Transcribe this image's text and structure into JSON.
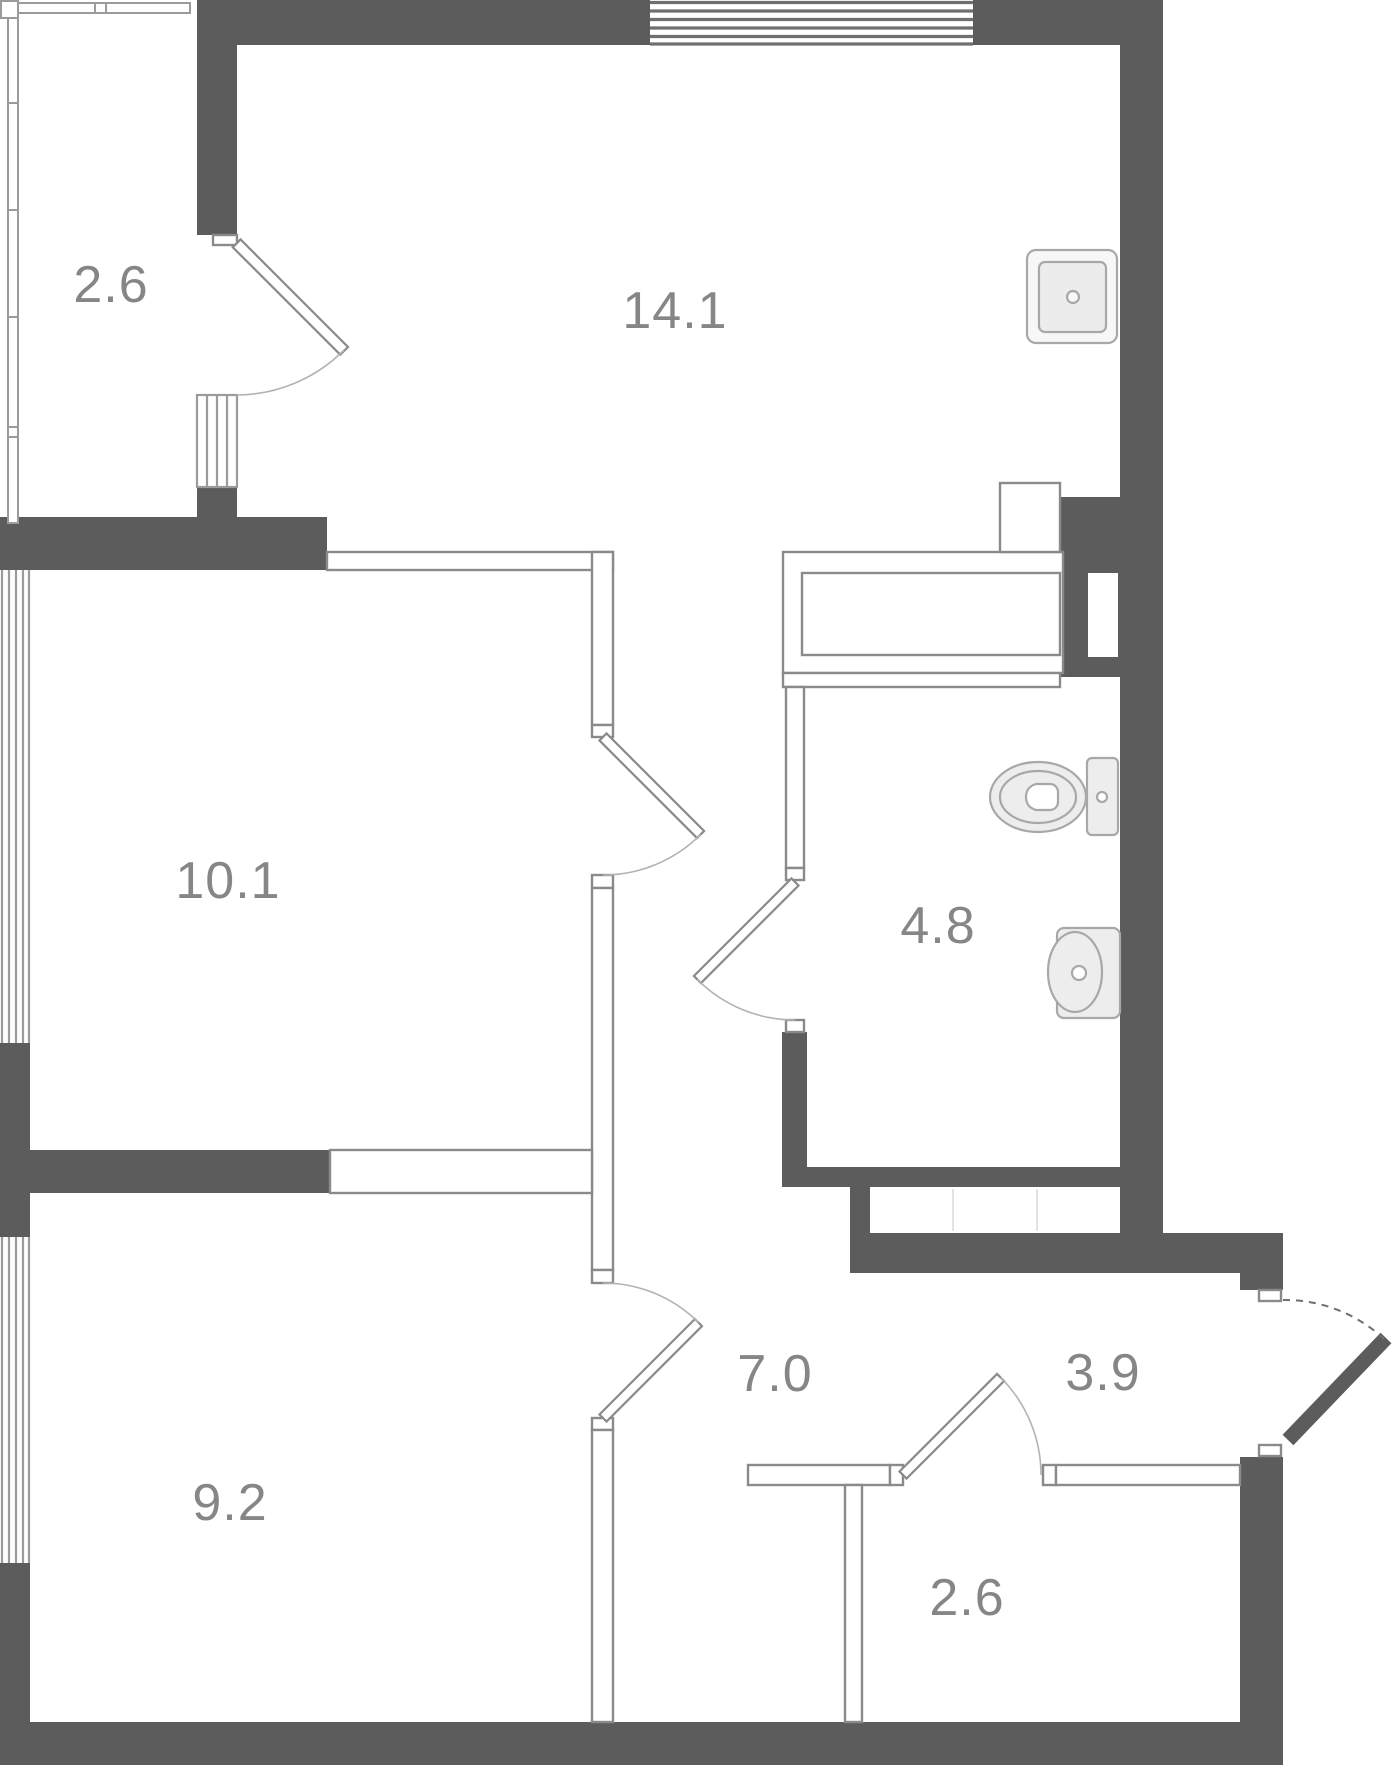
{
  "plan": {
    "type": "apartment-floor-plan",
    "colors": {
      "wall": "#5c5c5c",
      "thin_wall_line": "#8a8a8a",
      "window_line": "#9b9b9b",
      "door_arc": "#b3b3b3",
      "label": "#868686",
      "fixture_fill": "#f1f1f1",
      "fixture_stroke": "#a8a8a8",
      "background": "#ffffff"
    },
    "rooms": [
      {
        "id": "balcony",
        "area": "2.6"
      },
      {
        "id": "living-room",
        "area": "14.1"
      },
      {
        "id": "bedroom-1",
        "area": "10.1"
      },
      {
        "id": "bathroom",
        "area": "4.8"
      },
      {
        "id": "hallway",
        "area": "7.0"
      },
      {
        "id": "entry",
        "area": "3.9"
      },
      {
        "id": "bedroom-2",
        "area": "9.2"
      },
      {
        "id": "storage",
        "area": "2.6"
      }
    ],
    "fixtures": [
      {
        "id": "kitchen-sink"
      },
      {
        "id": "toilet"
      },
      {
        "id": "wash-basin"
      }
    ],
    "doors": [
      {
        "id": "balcony-door"
      },
      {
        "id": "bedroom-1-door"
      },
      {
        "id": "bathroom-door"
      },
      {
        "id": "bedroom-2-door"
      },
      {
        "id": "storage-door"
      },
      {
        "id": "entrance-door"
      }
    ]
  }
}
